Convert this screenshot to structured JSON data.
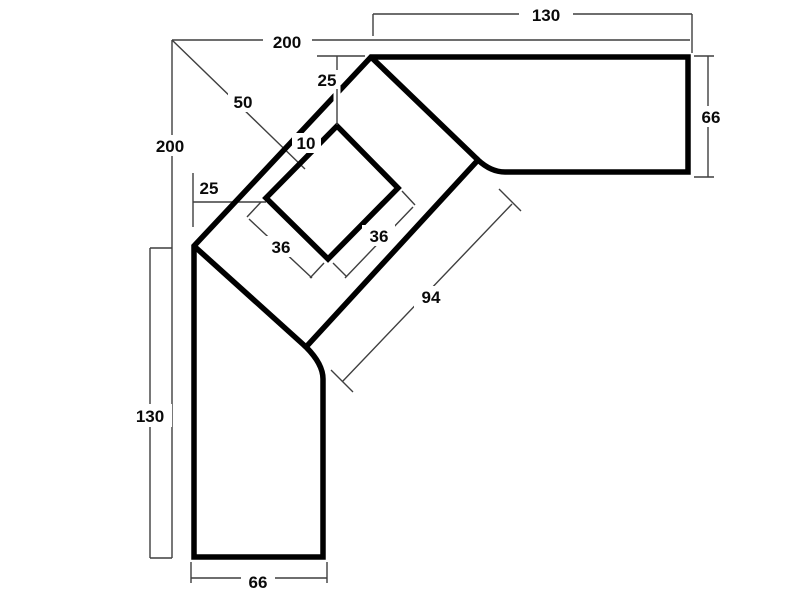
{
  "drawing": {
    "type": "technical-dimension-drawing",
    "subject": "corner-desk-plan-view",
    "colors": {
      "outline": "#000000",
      "dimension_line": "#3f3f3f",
      "background": "#ffffff",
      "label": "#0a0a0a"
    },
    "dimensions": {
      "top_right_length": "130",
      "overall_width": "200",
      "overall_height": "200",
      "right_depth": "66",
      "corner_diagonal": "50",
      "top_inset": "25",
      "cutout_gap": "10",
      "left_inset": "25",
      "cutout_side_left": "36",
      "cutout_side_right": "36",
      "inner_diagonal": "94",
      "left_lower_height": "130",
      "bottom_width": "66"
    }
  }
}
